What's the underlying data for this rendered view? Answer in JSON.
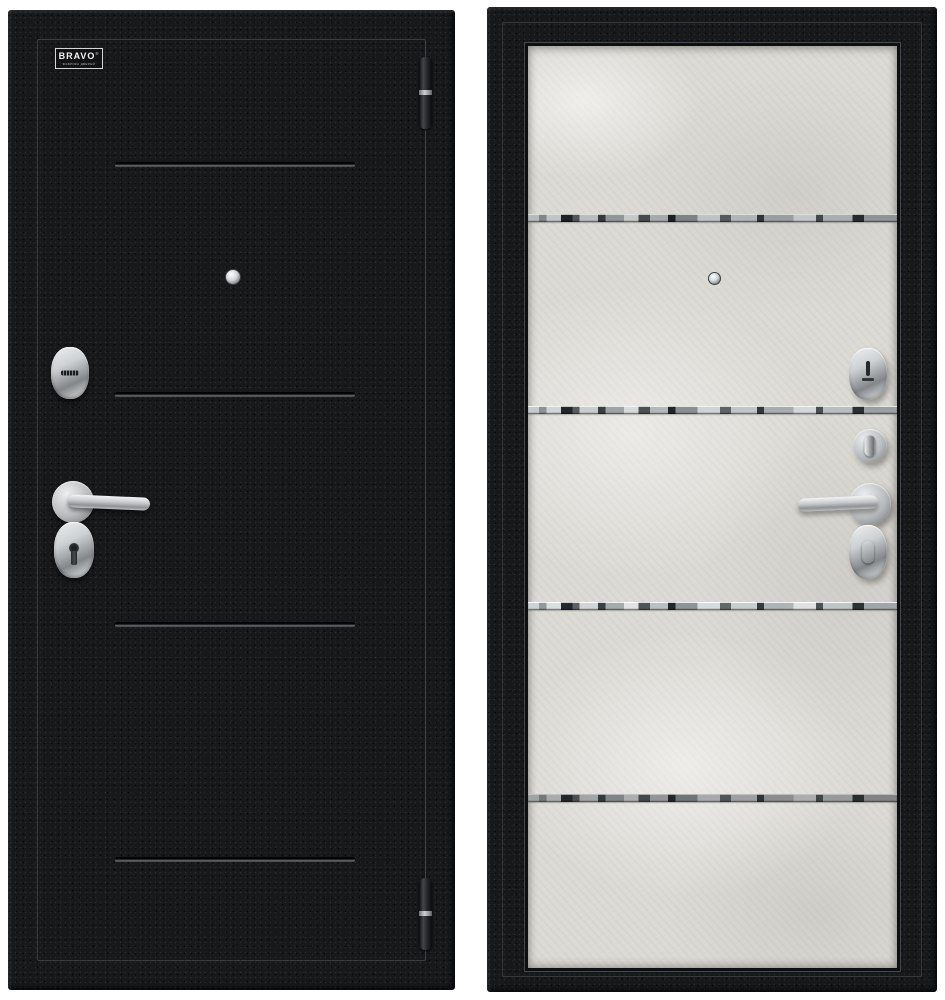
{
  "product": {
    "logo": {
      "text": "BRAVO",
      "reg": "®",
      "subtext": "ФАБРИКА ДВЕРЕЙ"
    }
  },
  "panels": {
    "left": {
      "side": "exterior",
      "finish_color": "#17181a",
      "decor": "four horizontal grooves",
      "hardware": [
        "cylinder-escutcheon",
        "lever-handle",
        "keyhole-escutcheon",
        "peephole",
        "hinge-top",
        "hinge-bottom"
      ]
    },
    "right": {
      "side": "interior",
      "finish_color": "#dcdad4",
      "decor": "four horizontal mirror strips",
      "hardware": [
        "slot-escutcheon",
        "thumbturn-cylinder",
        "lever-handle",
        "thumbturn-escutcheon",
        "peephole"
      ]
    }
  },
  "colors": {
    "page-bg": "#ffffff",
    "door-black": "#17181a",
    "groove-gray": "#606468",
    "concrete": "#dcdad4",
    "panel-border": "#0e0f10",
    "chrome-light": "#eef0f1",
    "chrome-mid": "#b9bcbe",
    "chrome-dark": "#84878a"
  }
}
